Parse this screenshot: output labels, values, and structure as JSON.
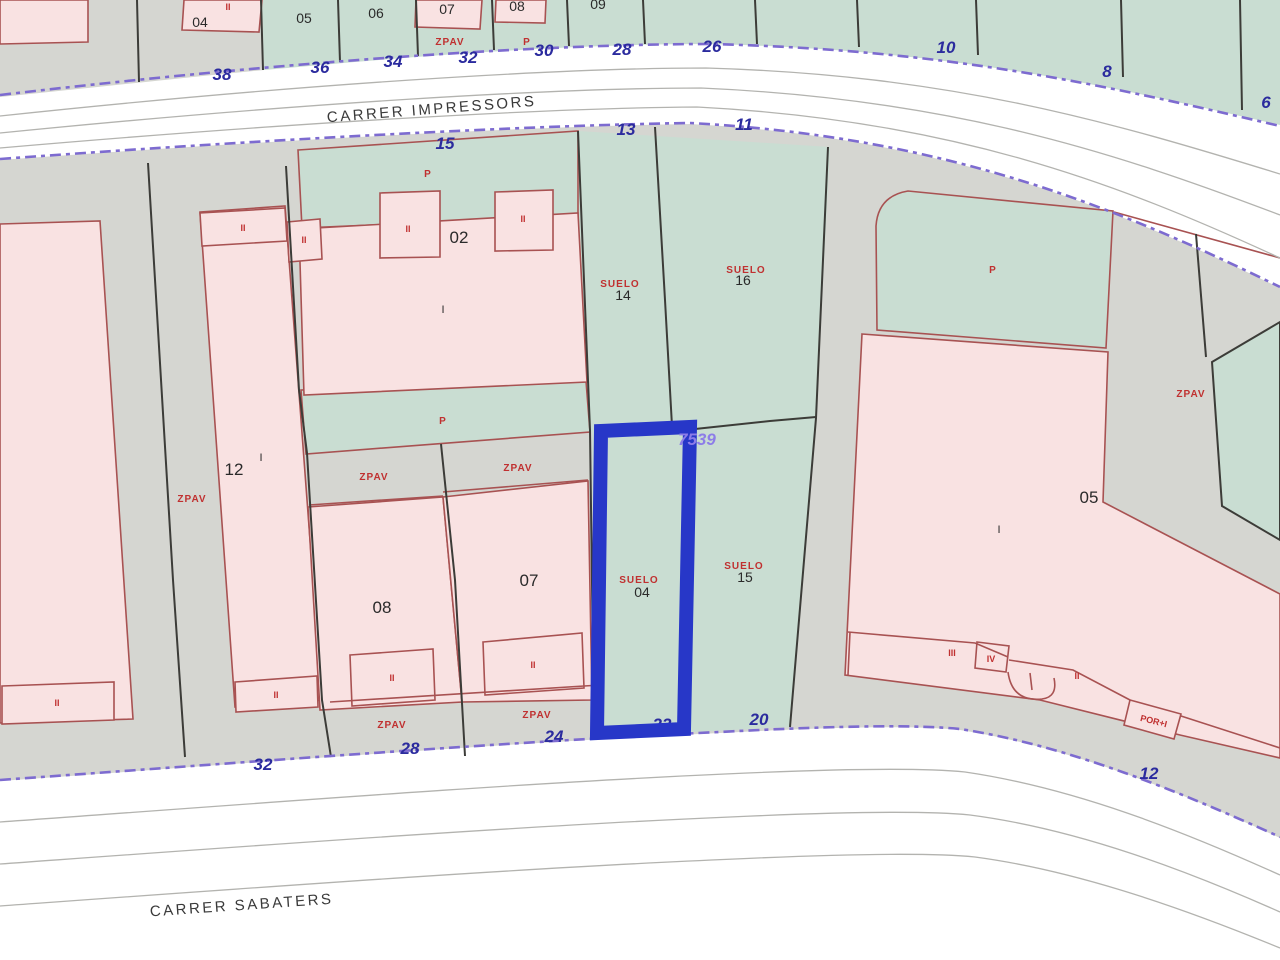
{
  "map": {
    "street_names": {
      "top": "CARRER IMPRESSORS",
      "bottom": "CARRER SABATERS"
    },
    "reference_number": "7539",
    "top_row_parcels": {
      "p04": "04",
      "p05": "05",
      "p06": "06",
      "p07": "07",
      "p08": "08",
      "p09": "09"
    },
    "parcel_numbers": {
      "p02": "02",
      "p12": "12",
      "p08": "08",
      "p07": "07",
      "p05": "05",
      "p14": "14",
      "p16": "16",
      "p15": "15",
      "p04_suelo": "04"
    },
    "house_numbers": {
      "top": [
        "38",
        "36",
        "34",
        "32",
        "30",
        "28",
        "26",
        "10",
        "8",
        "6"
      ],
      "top_inner": [
        "15",
        "13",
        "11"
      ],
      "bottom": [
        "32",
        "28",
        "24",
        "22",
        "20",
        "12"
      ]
    },
    "zone_labels": {
      "zpav": "ZPAV",
      "p": "P",
      "suelo": "SUELO",
      "por_i": "POR+I"
    },
    "storey_labels": {
      "i": "I",
      "ii": "II",
      "iii": "III",
      "iv": "IV"
    },
    "colors": {
      "parcel_green": "#c9ddd2",
      "parcel_pink": "#f9e2e2",
      "zone_gray": "#d5d6d1",
      "road_white": "#ffffff",
      "highlight_blue": "#2737c8",
      "street_edge_purple": "#7d6bd0",
      "label_red": "#c03030",
      "house_number_blue": "#2b2b9e",
      "reference_purple": "#8d7de8",
      "boundary_dark": "#3c3c38",
      "parcel_border_red": "#a85252"
    }
  }
}
